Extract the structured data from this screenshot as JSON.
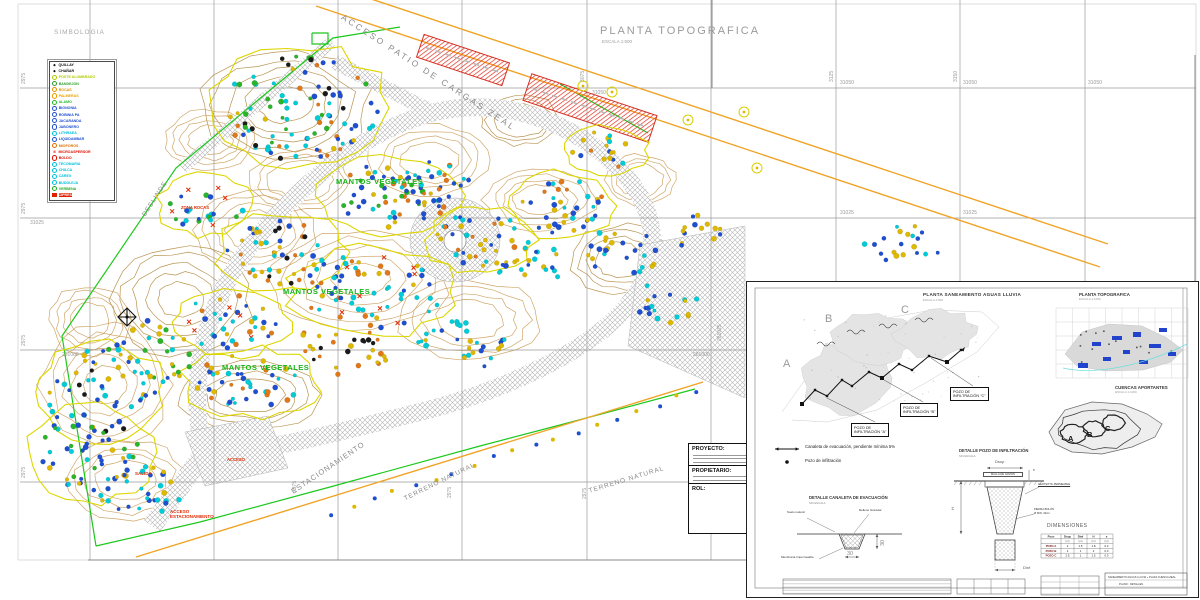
{
  "titles": {
    "simbologia": "SIMBOLOGIA",
    "main_title": "PLANTA TOPOGRAFICA",
    "main_scale": "ESCALA 1:500",
    "acceso": "ACCESO PATIO DE CARGAS ZEAL"
  },
  "legend": {
    "items": [
      {
        "label": "QUILLAY",
        "color": "#111111",
        "icon": "star"
      },
      {
        "label": "CHAÑAR",
        "color": "#111111",
        "icon": "star"
      },
      {
        "label": "POSTE ALUMBRADO",
        "color": "#b0cc00",
        "icon": "ring"
      },
      {
        "label": "BANDEJON",
        "color": "#2f9e2f",
        "icon": "ring"
      },
      {
        "label": "ROCAS",
        "color": "#e09000",
        "icon": "ring"
      },
      {
        "label": "PALMERAS",
        "color": "#e8a000",
        "icon": "ring"
      },
      {
        "label": "ALAMO",
        "color": "#22bb22",
        "icon": "ring"
      },
      {
        "label": "BIGNONIA",
        "color": "#2050d0",
        "icon": "ring"
      },
      {
        "label": "ROBINIA PA",
        "color": "#2050d0",
        "icon": "ring"
      },
      {
        "label": "JACARANDA",
        "color": "#2050d0",
        "icon": "ring"
      },
      {
        "label": "JABONERO",
        "color": "#2050d0",
        "icon": "ring"
      },
      {
        "label": "LITHRAEA",
        "color": "#00c0dc",
        "icon": "ring"
      },
      {
        "label": "LIQUIDAMBAR",
        "color": "#2050d0",
        "icon": "ring"
      },
      {
        "label": "MIOPOROS",
        "color": "#e07000",
        "icon": "ring"
      },
      {
        "label": "MICROASPERSOR",
        "color": "#e01000",
        "icon": "cross"
      },
      {
        "label": "BOLDO",
        "color": "#e01000",
        "icon": "ring"
      },
      {
        "label": "TECOMARIA",
        "color": "#00c0dc",
        "icon": "ring"
      },
      {
        "label": "CHILCA",
        "color": "#00c0dc",
        "icon": "ring"
      },
      {
        "label": "CAREX",
        "color": "#00c0dc",
        "icon": "ring"
      },
      {
        "label": "BUDDLEJA",
        "color": "#00c0dc",
        "icon": "ring"
      },
      {
        "label": "VERBENA",
        "color": "#22aa22",
        "icon": "ring"
      },
      {
        "label": "CIPRES",
        "color": "#e02000",
        "icon": "block"
      }
    ]
  },
  "grid": {
    "v": [
      90,
      214,
      338,
      462,
      587,
      711,
      836,
      960,
      1085
    ],
    "h": [
      88,
      218,
      350,
      482
    ],
    "labels": [
      [
        "2975",
        22,
        84,
        -90
      ],
      [
        "2975",
        22,
        214,
        -90
      ],
      [
        "2975",
        22,
        346,
        -90
      ],
      [
        "2975",
        22,
        478,
        -90
      ],
      [
        "31025",
        30,
        221,
        0
      ],
      [
        "261000",
        62,
        353,
        0
      ],
      [
        "3000",
        90,
        82,
        -90
      ],
      [
        "3075",
        581,
        82,
        -90
      ],
      [
        "31050",
        592,
        91,
        0
      ],
      [
        "3125",
        830,
        82,
        -90
      ],
      [
        "31050",
        840,
        81,
        0
      ],
      [
        "3150",
        954,
        82,
        -90
      ],
      [
        "31050",
        963,
        81,
        0
      ],
      [
        "31050",
        1088,
        81,
        0
      ],
      [
        "31025",
        840,
        211,
        0
      ],
      [
        "31025",
        963,
        211,
        0
      ],
      [
        "261000",
        693,
        353,
        0
      ],
      [
        "261025",
        718,
        341,
        -90
      ],
      [
        "2975",
        293,
        492,
        -90
      ],
      [
        "2975",
        448,
        498,
        -90
      ],
      [
        "2975",
        583,
        499,
        -90
      ]
    ]
  },
  "map": {
    "labels": [
      [
        "DESLINDE",
        141,
        214,
        -57,
        6.5,
        "#8a8a8a",
        1,
        0
      ],
      [
        "MANTOS VEGETALES",
        283,
        288,
        0,
        7.5,
        "#17b517",
        0.5,
        1
      ],
      [
        "MANTOS VEGETALES",
        336,
        178,
        0,
        7.5,
        "#17b517",
        0.5,
        1
      ],
      [
        "MANTOS VEGETALES",
        222,
        364,
        0,
        7.5,
        "#17b517",
        0.5,
        1
      ],
      [
        "ESTACIONAMIENTO",
        290,
        489,
        -34,
        7.5,
        "#8a8a8a",
        1,
        0
      ],
      [
        "TERRENO NATURAL",
        403,
        496,
        -26,
        6.5,
        "#8a8a8a",
        1,
        0
      ],
      [
        "TERRENO NATURAL",
        588,
        488,
        -17,
        6.5,
        "#8a8a8a",
        1,
        0
      ],
      [
        "SALIDA",
        135,
        471,
        0,
        4.5,
        "#e02800",
        0,
        1
      ],
      [
        "ACCESO\nESTACIONAMIENTO",
        170,
        509,
        0,
        4.5,
        "#e02800",
        0,
        1
      ],
      [
        "ZONA ROCAS",
        181,
        206,
        0,
        4.2,
        "#e02800",
        0,
        1
      ],
      [
        "ACCESO",
        227,
        458,
        0,
        4.2,
        "#e02800",
        0,
        1
      ]
    ],
    "clusters": [
      [
        300,
        108,
        78,
        52,
        95,
        "bbccgyok",
        1
      ],
      [
        392,
        196,
        62,
        32,
        55,
        "bbcgyo",
        1
      ],
      [
        282,
        252,
        55,
        32,
        48,
        "bcyok",
        1
      ],
      [
        372,
        292,
        72,
        38,
        65,
        "bbccyor",
        1
      ],
      [
        480,
        240,
        45,
        28,
        36,
        "bcyo",
        1
      ],
      [
        562,
        206,
        45,
        28,
        36,
        "bbcoy",
        1
      ],
      [
        622,
        252,
        40,
        24,
        26,
        "bcy",
        0
      ],
      [
        232,
        322,
        50,
        28,
        36,
        "bcoyr",
        1
      ],
      [
        152,
        352,
        45,
        32,
        34,
        "bcgy",
        0
      ],
      [
        100,
        392,
        55,
        42,
        48,
        "bbcyk",
        1
      ],
      [
        252,
        382,
        58,
        28,
        40,
        "bcyo",
        1
      ],
      [
        92,
        452,
        52,
        42,
        48,
        "bbcgy",
        1
      ],
      [
        142,
        492,
        42,
        26,
        30,
        "bcy",
        0
      ],
      [
        432,
        182,
        40,
        22,
        26,
        "bco",
        0
      ],
      [
        532,
        262,
        38,
        22,
        24,
        "bcy",
        0
      ],
      [
        668,
        302,
        32,
        22,
        18,
        "bcy",
        0
      ],
      [
        700,
        232,
        28,
        18,
        14,
        "by",
        0
      ],
      [
        902,
        243,
        52,
        18,
        20,
        "bcy",
        0
      ],
      [
        340,
        350,
        50,
        25,
        30,
        "yok",
        0
      ],
      [
        205,
        205,
        40,
        25,
        24,
        "bcgr",
        1
      ],
      [
        460,
        345,
        55,
        25,
        30,
        "bcy",
        0
      ],
      [
        605,
        150,
        35,
        20,
        18,
        "bcoy",
        1
      ]
    ],
    "contours": [
      [
        285,
        105,
        85,
        55,
        5
      ],
      [
        430,
        160,
        60,
        35,
        4
      ],
      [
        540,
        200,
        55,
        30,
        4
      ],
      [
        620,
        260,
        50,
        35,
        4
      ],
      [
        360,
        280,
        90,
        50,
        5
      ],
      [
        255,
        230,
        60,
        40,
        4
      ],
      [
        180,
        300,
        70,
        55,
        5
      ],
      [
        105,
        385,
        65,
        60,
        5
      ],
      [
        125,
        480,
        60,
        40,
        4
      ],
      [
        250,
        395,
        70,
        35,
        4
      ],
      [
        470,
        320,
        70,
        40,
        4
      ],
      [
        300,
        180,
        50,
        30,
        3
      ],
      [
        680,
        300,
        40,
        30,
        3
      ],
      [
        210,
        140,
        45,
        30,
        4
      ],
      [
        90,
        320,
        40,
        35,
        4
      ],
      [
        520,
        120,
        40,
        25,
        3
      ],
      [
        640,
        180,
        35,
        25,
        3
      ]
    ],
    "roads": [
      {
        "d": "M205,455 C185,385 205,300 255,240 C305,180 365,130 435,112 C505,96 575,122 622,172 C662,215 660,265 628,305 C590,352 500,392 420,412 C340,432 262,452 205,455",
        "w": 18
      },
      {
        "d": "M335,62 L432,112",
        "w": 15
      },
      {
        "d": "M205,452 L152,526",
        "w": 20
      },
      {
        "d": "M182,168 L332,42",
        "w": 12
      },
      {
        "d": "M628,302 L700,330",
        "w": 12
      }
    ],
    "areas": [
      "M640,245 L745,226 L745,398 L628,346 Z",
      "M185,432 L268,416 L288,468 L205,486 Z",
      "M410,240 a45,42 0 1,0 90,0 a45,42 0 1,0 -90,0 Z"
    ],
    "green": [
      [
        [
          96,
          546
        ],
        [
          62,
          336
        ],
        [
          176,
          168
        ],
        [
          333,
          38
        ],
        [
          400,
          27
        ]
      ],
      [
        [
          96,
          546
        ],
        [
          200,
          522
        ],
        [
          330,
          487
        ],
        [
          480,
          446
        ],
        [
          560,
          425
        ],
        [
          695,
          389
        ]
      ],
      [
        [
          560,
          84
        ],
        [
          648,
          133
        ]
      ],
      [
        [
          312,
          33
        ],
        [
          328,
          33
        ],
        [
          328,
          44
        ],
        [
          312,
          44
        ],
        [
          312,
          33
        ]
      ]
    ],
    "orange": [
      [
        316,
        6,
        1100,
        267
      ],
      [
        338,
        -12,
        1108,
        244
      ],
      [
        136,
        557,
        703,
        382
      ]
    ],
    "red_rects": [
      [
        463,
        60,
        90,
        24,
        18.5
      ],
      [
        590,
        108,
        132,
        28,
        18.5
      ]
    ],
    "scatter": {
      "x1": 332,
      "y1": 513,
      "x2": 698,
      "y2": 391,
      "n": 19
    },
    "rings": [
      [
        757,
        168
      ],
      [
        744,
        112
      ],
      [
        612,
        92
      ],
      [
        583,
        86
      ],
      [
        688,
        120
      ]
    ],
    "compass": [
      127,
      317
    ],
    "rotonda": [
      455,
      241,
      11
    ]
  },
  "titleblock": {
    "proyecto": "PROYECTO:",
    "propietario": "PROPIETARIO:",
    "rol": "ROL:"
  },
  "inset": {
    "plan_title": "PLANTA SANEAMIENTO AGUAS LLUVIA",
    "plan_scale": "ESCALA 1:500",
    "letters": [
      {
        "t": "A",
        "x": 36,
        "y": 76
      },
      {
        "t": "B",
        "x": 78,
        "y": 31
      },
      {
        "t": "C",
        "x": 154,
        "y": 22
      }
    ],
    "pozos": [
      {
        "l1": "POZO DE",
        "l2": "INFILTRACIÓN \"A\"",
        "x": 104,
        "y": 141
      },
      {
        "l1": "POZO DE",
        "l2": "INFILTRACIÓN \"B\"",
        "x": 153,
        "y": 121
      },
      {
        "l1": "POZO DE",
        "l2": "INFILTRACIÓN \"C\"",
        "x": 203,
        "y": 105
      }
    ],
    "legend": [
      {
        "t": "Canaleta de evacuación, pendiente mínima 5%"
      },
      {
        "t": "Pozo de infiltración"
      }
    ],
    "mini1_title": "PLANTA TOPOGRAFICA",
    "mini1_scale": "ESCALA 1:1000",
    "mini2_title": "CUENCAS APORTANTES",
    "mini2_scale": "ESCALA 1:1000",
    "mini2_letters": [
      {
        "t": "A",
        "x": 321,
        "y": 153
      },
      {
        "t": "B",
        "x": 340,
        "y": 149
      },
      {
        "t": "C",
        "x": 358,
        "y": 143
      }
    ],
    "det1_title": "DETALLE CANALETA DE EVACUACIÓN",
    "det1_scale": "SIN ESCALA",
    "det1": {
      "suelo": "Suelo natural",
      "relleno": "Relleno Granular",
      "membrana": "Membrana Impermeable",
      "dim_v": "30",
      "dim_h": "30"
    },
    "det2_title": "DETALLE POZO DE INFILTRACIÓN",
    "det2_scale": "SIN ESCALA",
    "det2": {
      "dsup": "Dsup",
      "e": "e",
      "malla": "MALLA DE GAVIÓN",
      "geo": "GEOTEXTIL PERMEABLE",
      "piedra1": "PIEDRA BOLÓN",
      "piedra2": "Ø MIN. 30cm",
      "h": "H",
      "dinf": "Dinf"
    },
    "dims_title": "DIMENSIONES",
    "table": {
      "headers": [
        "Pozo",
        "Dsup",
        "Dinf",
        "H",
        "e"
      ],
      "units": [
        "",
        "(m)",
        "(m)",
        "(m)",
        "(m)"
      ],
      "rows": [
        [
          "POZO A",
          "2",
          "1.5",
          "1.8",
          "0.3"
        ],
        [
          "POZO B",
          "2",
          "1",
          "2",
          "0.3"
        ],
        [
          "POZO C",
          "2.5",
          "1",
          "1.5",
          "0.3"
        ]
      ]
    },
    "tblock": {
      "l1": "SANEAMIENTO AGUAS LLUVIA + PLAZA CUENCA ZEAL",
      "l2": "PLANO : DETALLES"
    }
  }
}
